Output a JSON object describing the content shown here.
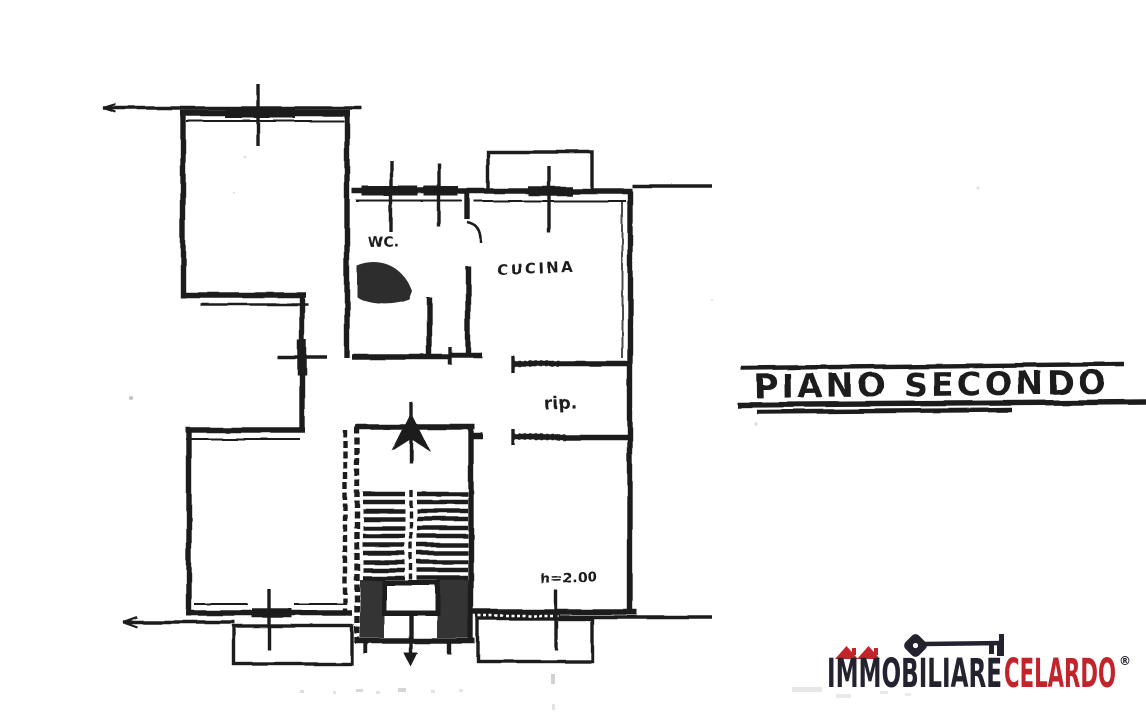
{
  "colors": {
    "ink": "#1e1e1e",
    "paper": "#ffffff",
    "brand_dark": "#23222e",
    "brand_red": "#c2242b"
  },
  "plan": {
    "floor_title": "PIANO SECONDO",
    "room_labels": {
      "wc": "WC.",
      "kitchen": "CUCINA",
      "storage": "rip."
    },
    "height_annotation": "h=2.00"
  },
  "logo": {
    "brand_part_dark": "IMMOBILIARE",
    "brand_part_red": "CELARDO",
    "registered_mark": "®"
  }
}
